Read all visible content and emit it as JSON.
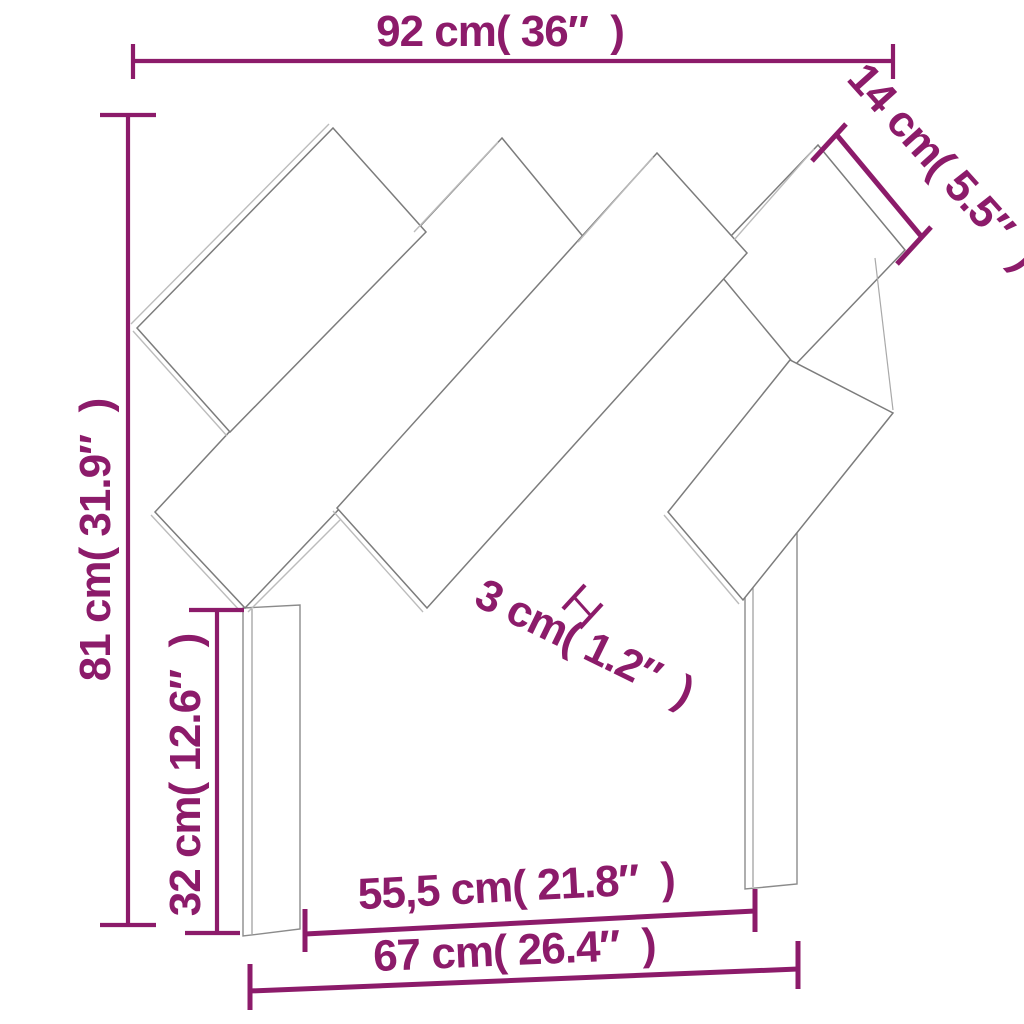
{
  "diagram": {
    "type": "product-dimension-diagram",
    "subject": "wooden headboard with diagonal slats and two legs",
    "background_color": "#ffffff",
    "accent_color": "#8c1b6a",
    "drawing_line_color": "#7c7c7c"
  },
  "dimensions": {
    "overall_width": {
      "label": "92 cm( 36″  )",
      "cm": "92",
      "in": "36"
    },
    "slat_width": {
      "label": "14 cm( 5.5″  )",
      "cm": "14",
      "in": "5.5"
    },
    "overall_height": {
      "label": "81 cm( 31.9″  )",
      "cm": "81",
      "in": "31.9"
    },
    "leg_height": {
      "label": "32 cm( 12.6″  )",
      "cm": "32",
      "in": "12.6"
    },
    "slat_thickness": {
      "label": "3 cm( 1.2″  )",
      "cm": "3",
      "in": "1.2"
    },
    "inner_span": {
      "label": "55,5 cm( 21.8″  )",
      "cm": "55,5",
      "in": "21.8"
    },
    "leg_span": {
      "label": "67 cm( 26.4″  )",
      "cm": "67",
      "in": "26.4"
    }
  }
}
